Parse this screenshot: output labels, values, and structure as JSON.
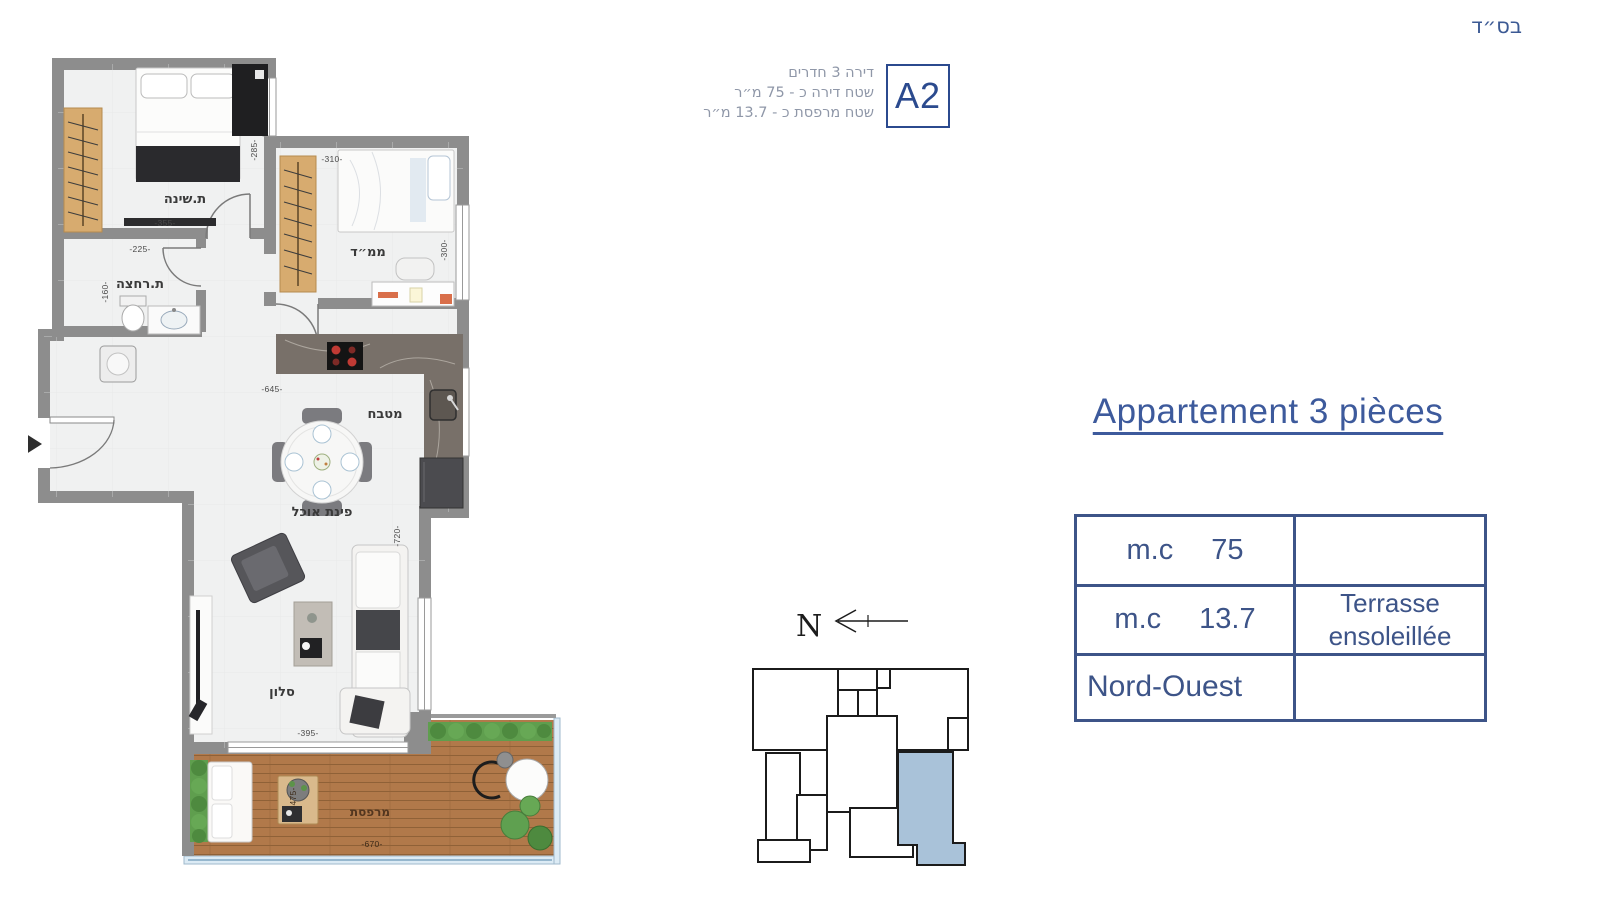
{
  "page": {
    "bsd": "בס״ד"
  },
  "header": {
    "unit": "A2",
    "line1": "דירה 3 חדרים",
    "line2": "שטח דירה כ - 75 מ״ר",
    "line3": "שטח מרפסת כ - 13.7 מ״ר"
  },
  "plan": {
    "rooms": {
      "bedroom": "ת.שינה",
      "mamad": "ממ״ד",
      "bathroom": "ת.רחצה",
      "kitchen": "מטבח",
      "dining": "פינת אוכל",
      "living": "סלון",
      "balcony": "מרפסת"
    },
    "dims": {
      "bedroom_w": "-355-",
      "bedroom_h": "-285-",
      "mamad_w": "-310-",
      "mamad_h": "-300-",
      "bath_w": "-225-",
      "bath_h": "-160-",
      "kitchen_w": "-645-",
      "living_w": "-395-",
      "living_h": "-720-",
      "balcony_w": "-670-",
      "balcony_h": "-475-"
    }
  },
  "compass": {
    "north": "N"
  },
  "panel": {
    "title": "Appartement 3 pièces",
    "table": {
      "r1_left_unit": "m.c",
      "r1_left_value": "75",
      "r1_right": "",
      "r2_left_unit": "m.c",
      "r2_left_value": "13.7",
      "r2_right_line1": "Terrasse",
      "r2_right_line2": "ensoleillée",
      "r3_left": "Nord-Ouest",
      "r3_right": ""
    }
  },
  "colors": {
    "accent": "#3d5488",
    "muted": "#8f97a8",
    "unit_highlight": "#a9c2d9",
    "wall": "#8d8d8d"
  }
}
